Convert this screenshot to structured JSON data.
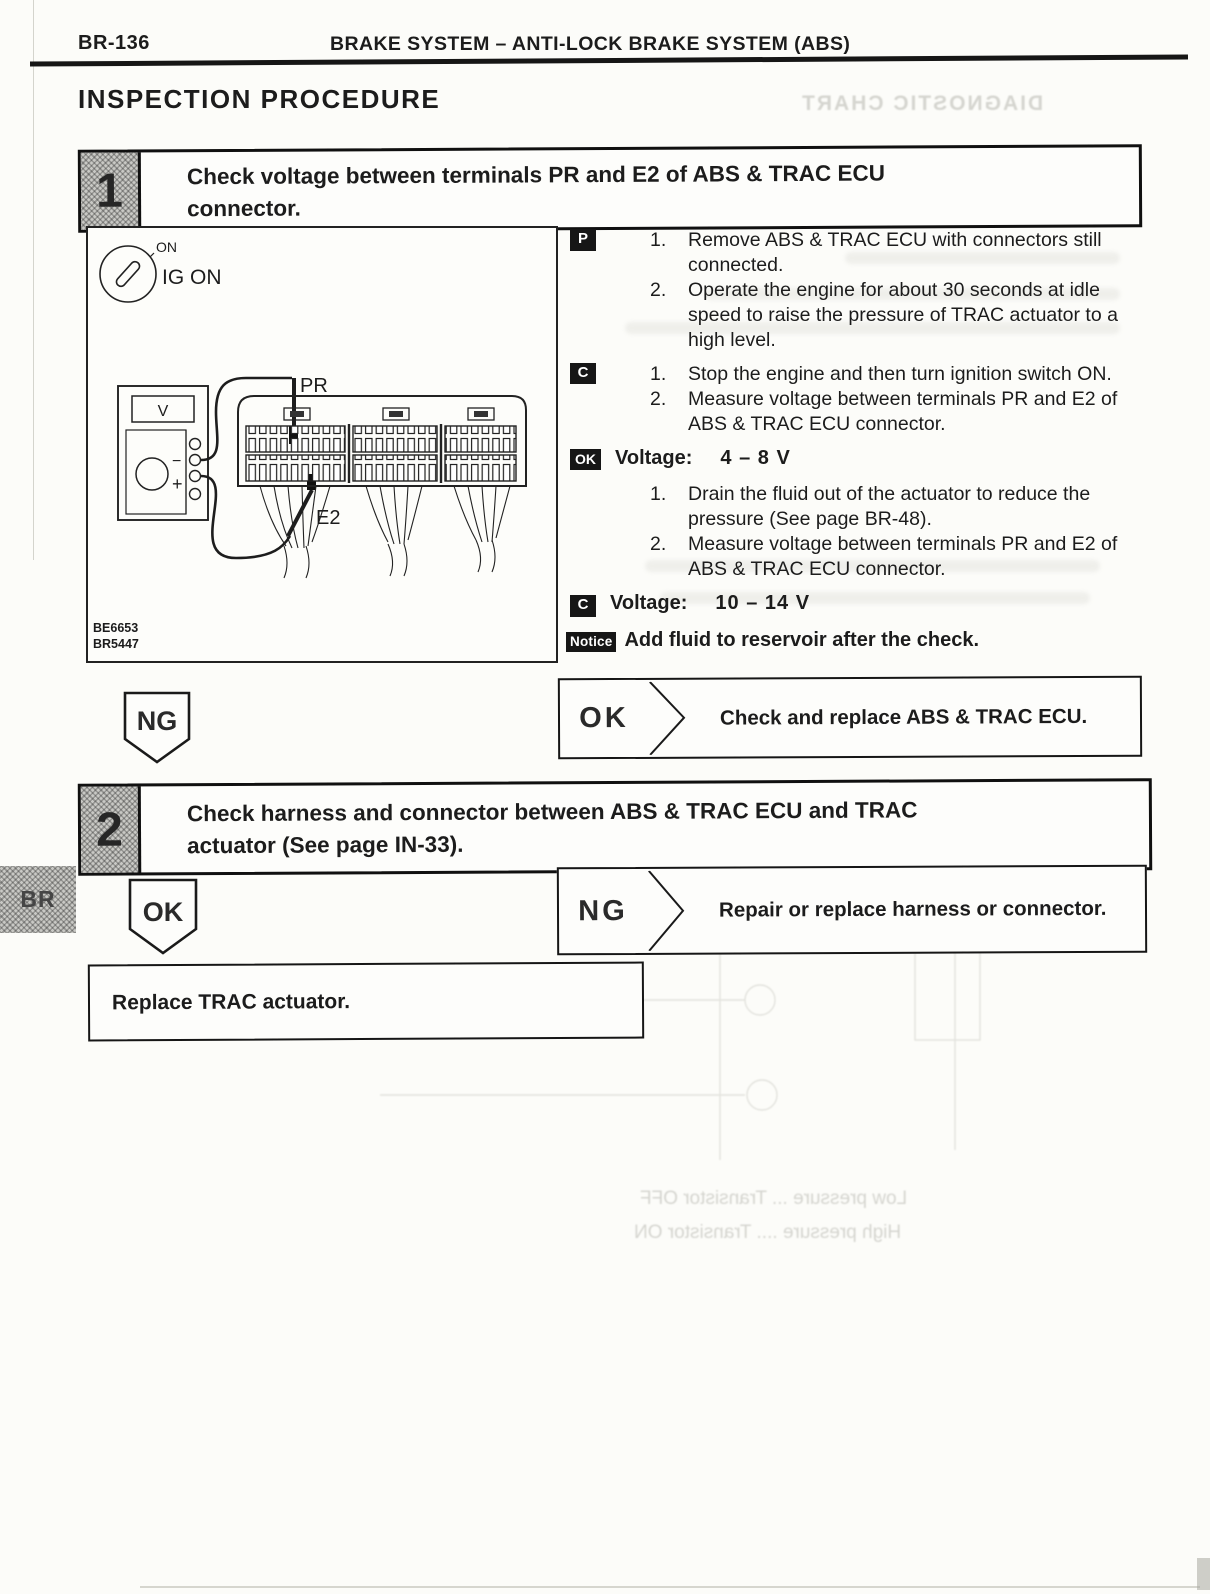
{
  "page": {
    "page_code": "BR-136",
    "header_title": "BRAKE SYSTEM – ANTI-LOCK BRAKE SYSTEM (ABS)",
    "section_title": "INSPECTION PROCEDURE",
    "side_tab": "BR"
  },
  "step1": {
    "number": "1",
    "title": "Check voltage between terminals PR and E2 of ABS & TRAC ECU connector.",
    "figure": {
      "key_label_top": "ON",
      "key_label": "IG ON",
      "meter_display": "V",
      "meter_minus": "−",
      "meter_plus": "+",
      "label_pr": "PR",
      "label_e2": "E2",
      "code1": "BE6653",
      "code2": "BR5447"
    },
    "blocks": {
      "p": {
        "badge": "P",
        "item1_num": "1.",
        "item1": "Remove ABS & TRAC ECU with connectors still connected.",
        "item2_num": "2.",
        "item2": "Operate the engine for about 30 seconds at idle speed to raise the pressure of TRAC actuator to a high level."
      },
      "c": {
        "badge": "C",
        "item1_num": "1.",
        "item1": "Stop the engine and then turn ignition switch ON.",
        "item2_num": "2.",
        "item2": "Measure voltage between terminals PR and E2 of ABS & TRAC ECU connector."
      },
      "ok_spec": {
        "badge": "OK",
        "label": "Voltage:",
        "value": "4 – 8 V"
      },
      "drain": {
        "item1_num": "1.",
        "item1": "Drain the fluid out of the actuator to reduce the pressure (See page BR-48).",
        "item2_num": "2.",
        "item2": "Measure voltage between terminals PR and E2 of ABS & TRAC ECU connector."
      },
      "c_spec": {
        "badge": "C",
        "label": "Voltage:",
        "value": "10 – 14 V"
      },
      "notice": {
        "badge": "Notice",
        "text": "Add fluid to reservoir after the check."
      }
    },
    "ng_label": "NG",
    "ok_result": {
      "label": "OK",
      "action": "Check and replace ABS & TRAC ECU."
    }
  },
  "step2": {
    "number": "2",
    "title": "Check harness and connector between ABS & TRAC ECU and TRAC actuator (See page IN-33).",
    "ok_label": "OK",
    "ng_result": {
      "label": "NG",
      "action": "Repair or replace harness or connector."
    },
    "final_action": "Replace TRAC actuator."
  },
  "bleed_through": {
    "top_right": "DIAGNOSTIC CHART",
    "bottom_line1": "Low pressure ... Transistor OFF",
    "bottom_line2": "High pressure .... Transistor ON"
  }
}
